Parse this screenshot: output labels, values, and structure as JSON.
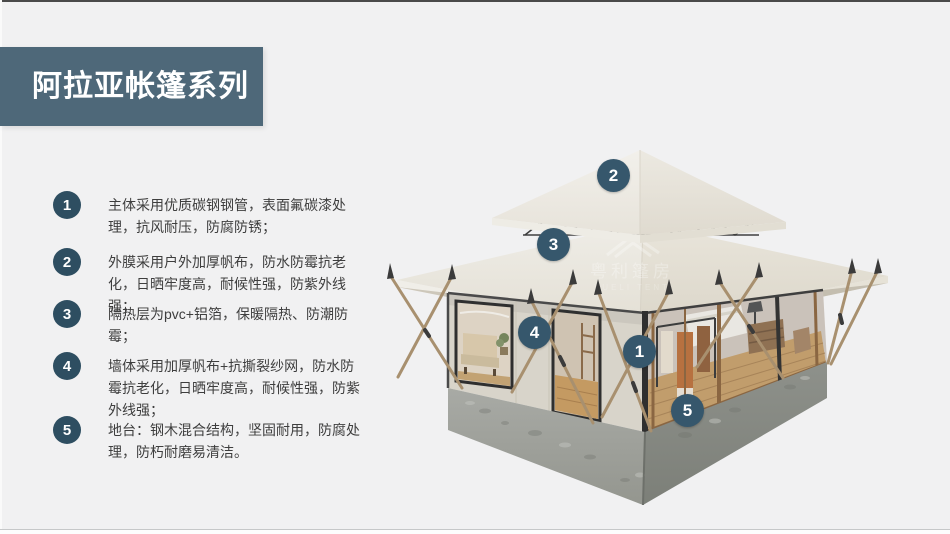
{
  "page": {
    "background_color": "#f1f1f2",
    "top_edge_color": "#4a4a4a"
  },
  "header": {
    "title": "阿拉亚帐篷系列",
    "banner_color": "#4e6879",
    "title_color": "#ffffff"
  },
  "features": [
    {
      "num": "1",
      "text": "主体采用优质碳钢钢管，表面氟碳漆处理，抗风耐压，防腐防锈；"
    },
    {
      "num": "2",
      "text": "外膜采用户外加厚帆布，防水防霉抗老化，日晒牢度高，耐候性强，防紫外线强；"
    },
    {
      "num": "3",
      "text": "隔热层为pvc+铝箔，保暖隔热、防潮防霉；"
    },
    {
      "num": "4",
      "text": "墙体采用加厚帆布+抗撕裂纱网，防水防霉抗老化，日晒牢度高，耐候性强，防紫外线强；"
    },
    {
      "num": "5",
      "text": "地台：钢木混合结构，坚固耐用，防腐处理，防朽耐磨易清洁。"
    }
  ],
  "feature_badge_color": "#2e4e61",
  "diagram": {
    "description": "glamping tent with double pagoda roof, canvas walls, glass doors, wood poles and concrete-steel platform",
    "callout_badge_color": "#36576c",
    "callouts": [
      {
        "num": "1"
      },
      {
        "num": "2"
      },
      {
        "num": "3"
      },
      {
        "num": "4"
      },
      {
        "num": "5"
      }
    ],
    "watermark": {
      "cn": "粤利篷房",
      "en": "YUELI TENT"
    }
  }
}
